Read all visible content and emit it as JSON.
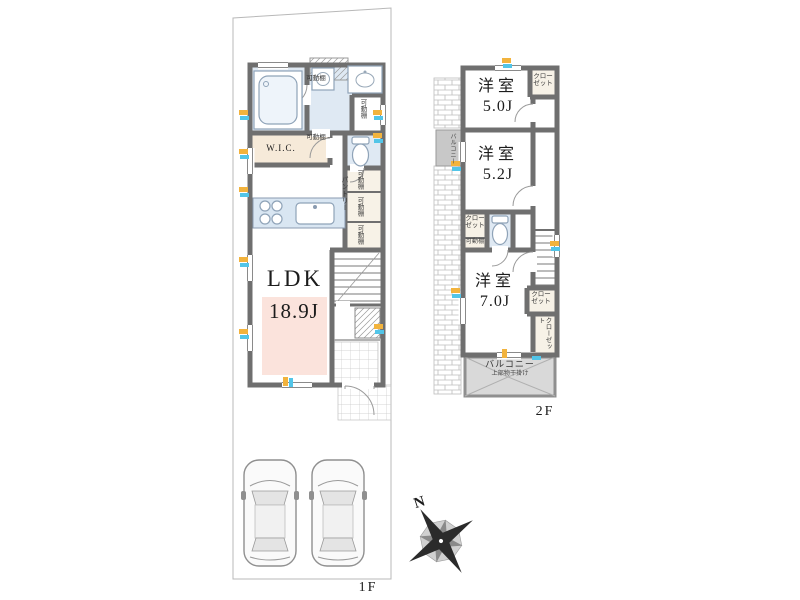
{
  "floor1": {
    "label": "1F",
    "ldk_name": "LDK",
    "ldk_size": "18.9J",
    "wic": "W.I.C.",
    "pantry": "パントリー",
    "movable_shelf": "可動棚"
  },
  "floor2": {
    "label": "2F",
    "rooms": [
      {
        "name": "洋室",
        "size": "5.0J"
      },
      {
        "name": "洋室",
        "size": "5.2J"
      },
      {
        "name": "洋室",
        "size": "7.0J"
      }
    ],
    "closet": "クローゼット",
    "movable_shelf": "可動棚",
    "balcony_name": "バルコニー",
    "balcony_note": "上部物干掛け",
    "side_balcony": "バルコニー"
  },
  "compass": {
    "north": "N"
  },
  "colors": {
    "wall": "#6f6f6f",
    "wet_floor": "#dfe9f3",
    "wic_floor": "#f6ead9",
    "ldk_highlight": "#fbe3dc",
    "balcony_fill": "#d9d9d9",
    "closet_fill": "#f7f2e7",
    "marker_yellow": "#f2b33d",
    "marker_cyan": "#52c5e8"
  }
}
